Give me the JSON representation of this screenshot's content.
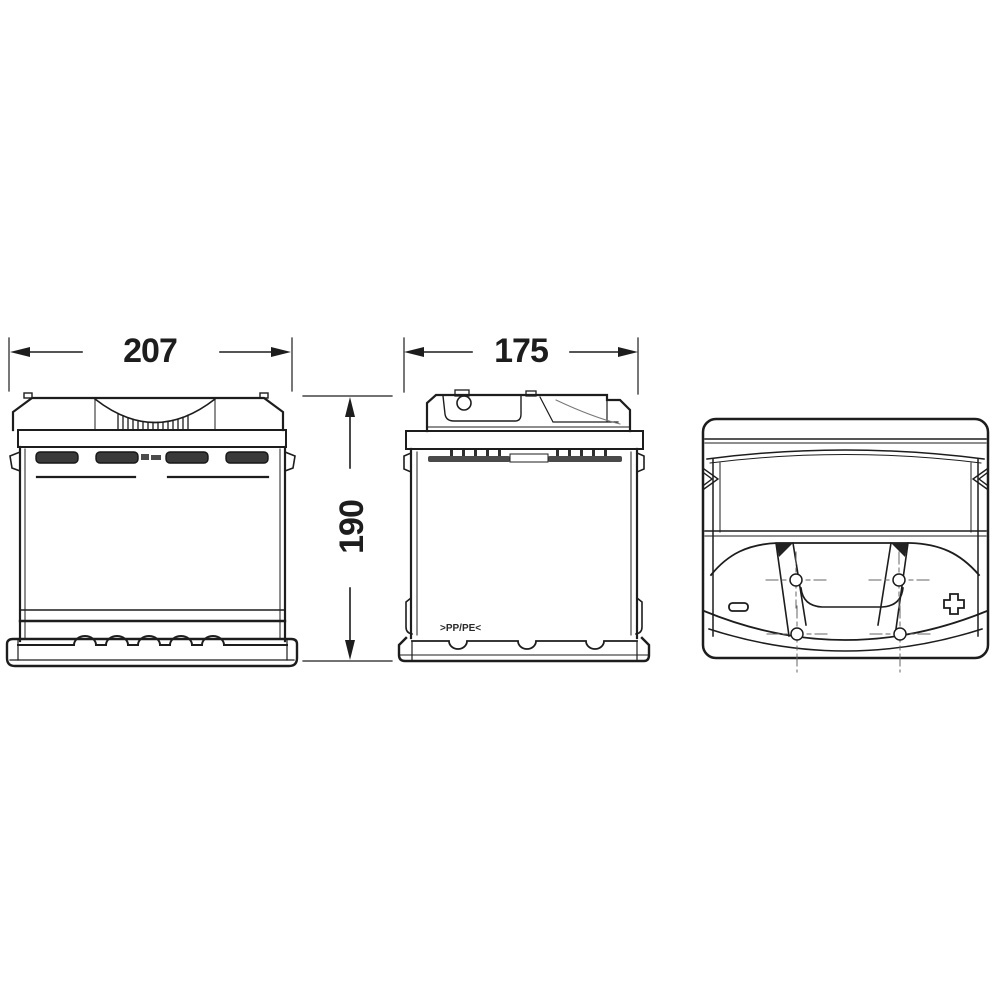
{
  "dimensions": {
    "front_width": "207",
    "side_depth": "175",
    "height": "190"
  },
  "markings": {
    "recycling_code": ">PP/PE<",
    "negative_terminal": "−",
    "positive_terminal": "+"
  },
  "colors": {
    "background": "#ffffff",
    "line": "#1d1d1d",
    "plug_fill": "#3a3a3a",
    "strip_fill": "#4a4a4a"
  }
}
